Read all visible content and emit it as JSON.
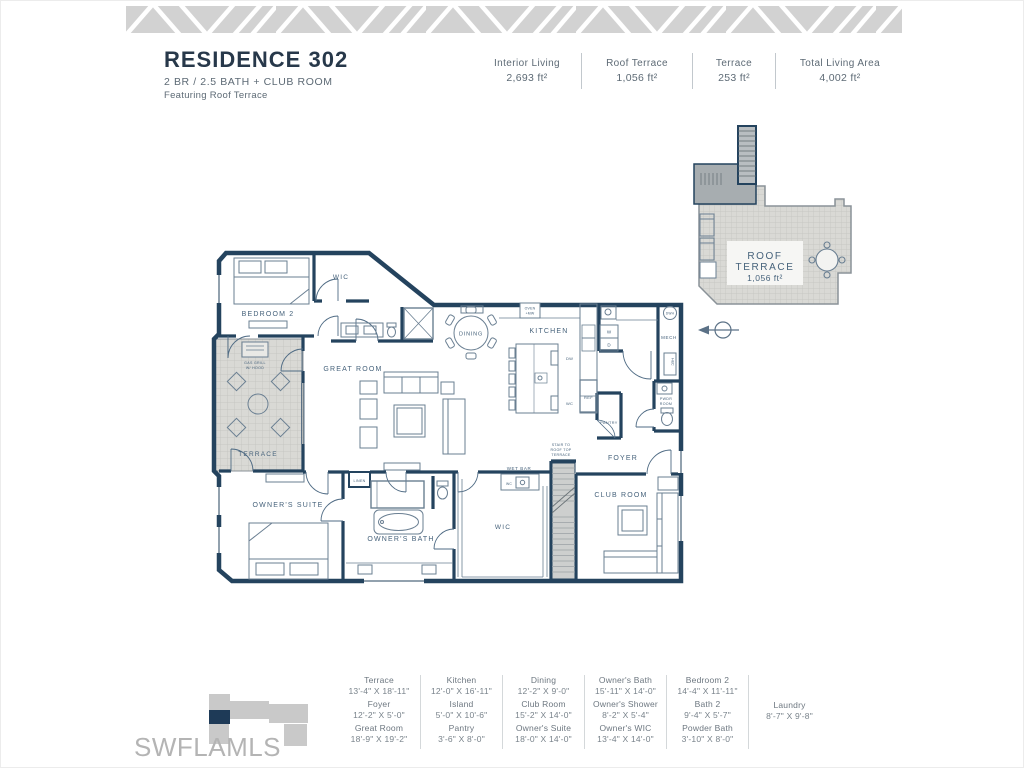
{
  "header": {
    "title": "RESIDENCE 302",
    "subtitle": "2 BR / 2.5 BATH + CLUB ROOM",
    "tagline": "Featuring Roof Terrace"
  },
  "stats": {
    "items": [
      {
        "label": "Interior Living",
        "value": "2,693 ft²"
      },
      {
        "label": "Roof Terrace",
        "value": "1,056 ft²"
      },
      {
        "label": "Terrace",
        "value": "253 ft²"
      },
      {
        "label": "Total Living Area",
        "value": "4,002 ft²"
      }
    ]
  },
  "roof_inset": {
    "name_line1": "ROOF",
    "name_line2": "TERRACE",
    "area": "1,056 ft²"
  },
  "plan": {
    "rooms": {
      "bedroom2": "BEDROOM 2",
      "wic_bedroom2": "WIC",
      "great_room": "GREAT ROOM",
      "dining": "DINING",
      "kitchen": "KITCHEN",
      "terrace": "TERRACE",
      "gas_grill_line1": "GAS GRILL",
      "gas_grill_line2": "W/ HOOD",
      "owners_suite": "OWNER'S SUITE",
      "owners_bath": "OWNER'S BATH",
      "linen": "LINEN",
      "owners_wic": "WIC",
      "wet_bar": "WET BAR",
      "wet_bar_wc": "WC",
      "stair_line1": "STAIR TO",
      "stair_line2": "ROOF TOP",
      "stair_line3": "TERRACE",
      "foyer": "FOYER",
      "club_room": "CLUB ROOM",
      "pantry": "PANTRY",
      "ref": "REF",
      "dw": "DW",
      "island_wc": "WC",
      "oven_mw_line1": "OVEN",
      "oven_mw_line2": "+MW",
      "washer": "W",
      "dryer": "D",
      "mech": "MECH",
      "dwh": "DWH",
      "hc": "H&C",
      "pwdr_line1": "PWDR",
      "pwdr_line2": "ROOM"
    }
  },
  "dims": {
    "columns": [
      {
        "items": [
          {
            "name": "Terrace",
            "size": "13'-4\" X 18'-11\""
          },
          {
            "name": "Foyer",
            "size": "12'-2\" X 5'-0\""
          },
          {
            "name": "Great Room",
            "size": "18'-9\" X 19'-2\""
          }
        ]
      },
      {
        "items": [
          {
            "name": "Kitchen",
            "size": "12'-0\" X 16'-11\""
          },
          {
            "name": "Island",
            "size": "5'-0\" X 10'-6\""
          },
          {
            "name": "Pantry",
            "size": "3'-6\" X 8'-0\""
          }
        ]
      },
      {
        "items": [
          {
            "name": "Dining",
            "size": "12'-2\" X 9'-0\""
          },
          {
            "name": "Club Room",
            "size": "15'-2\" X 14'-0\""
          },
          {
            "name": "Owner's Suite",
            "size": "18'-0\" X 14'-0\""
          }
        ]
      },
      {
        "items": [
          {
            "name": "Owner's Bath",
            "size": "15'-11\" X 14'-0\""
          },
          {
            "name": "Owner's Shower",
            "size": "8'-2\" X 5'-4\""
          },
          {
            "name": "Owner's WIC",
            "size": "13'-4\" X 14'-0\""
          }
        ]
      },
      {
        "items": [
          {
            "name": "Bedroom 2",
            "size": "14'-4\" X 11'-11\""
          },
          {
            "name": "Bath 2",
            "size": "9'-4\" X 5'-7\""
          },
          {
            "name": "Powder Bath",
            "size": "3'-10\" X 8'-0\""
          }
        ]
      },
      {
        "items": [
          {
            "name": "Laundry",
            "size": "8'-7\" X 9'-8\""
          }
        ]
      }
    ]
  },
  "watermark": "SWFLAMLS",
  "colors": {
    "wall_navy": "#24435e",
    "terrace_gray": "#d9d9d5",
    "band_gray": "#d2d2d2",
    "text_gray": "#5d6a75",
    "watermark_gray": "#b4b4b4"
  }
}
